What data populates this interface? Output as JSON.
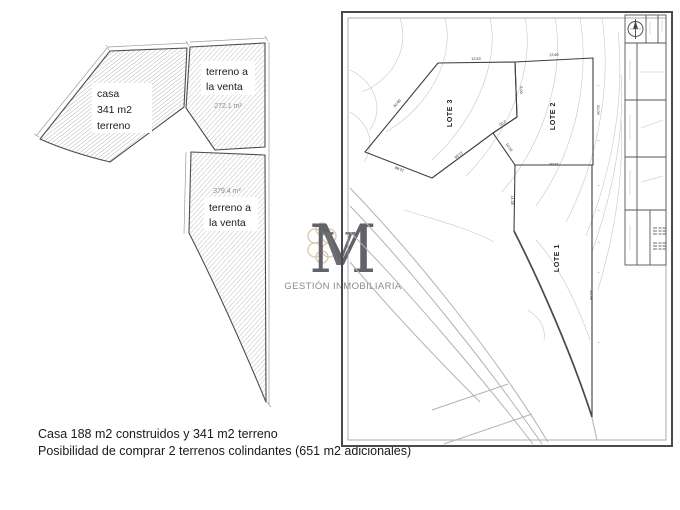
{
  "left_diagram": {
    "house_label": {
      "line1": "casa",
      "line2": "341 m2",
      "line3": "terreno"
    },
    "plot_upper": {
      "label_line1": "terreno a",
      "label_line2": "la venta",
      "area": "272.1 m²"
    },
    "plot_lower": {
      "area": "379.4 m²",
      "label_line1": "terreno a",
      "label_line2": "la venta"
    }
  },
  "logo": {
    "monogram_main": "M",
    "monogram_overlay": "V",
    "caption": "GESTIÓN INMOBILIARIA",
    "flourish_color": "#d9bfa0",
    "monogram_color": "#62626a"
  },
  "site_plan": {
    "lot_labels": [
      {
        "text": "LOTE 3",
        "x": 112,
        "y": 103
      },
      {
        "text": "LOTE 2",
        "x": 215,
        "y": 106
      },
      {
        "text": "LOTE 1",
        "x": 219,
        "y": 248
      }
    ],
    "dimensions": [
      {
        "text": "13.53",
        "x": 136,
        "y": 50,
        "r": -2
      },
      {
        "text": "13.60",
        "x": 214,
        "y": 46,
        "r": -3
      },
      {
        "text": "5.00",
        "x": 180,
        "y": 80,
        "r": 90
      },
      {
        "text": "20.00",
        "x": 58,
        "y": 94,
        "r": -51
      },
      {
        "text": "12.88",
        "x": 60,
        "y": 158,
        "r": 201
      },
      {
        "text": "12.66",
        "x": 118,
        "y": 144,
        "r": 143
      },
      {
        "text": "10.00",
        "x": 168,
        "y": 138,
        "r": 56
      },
      {
        "text": "2.00",
        "x": 162,
        "y": 112,
        "r": 147
      },
      {
        "text": "10.00",
        "x": 257,
        "y": 100,
        "r": 90
      },
      {
        "text": "13.60",
        "x": 214,
        "y": 153,
        "r": 180
      },
      {
        "text": "14.38",
        "x": 171,
        "y": 190,
        "r": 89
      },
      {
        "text": "43.98",
        "x": 250,
        "y": 285,
        "r": 90
      }
    ]
  },
  "caption": {
    "line1": "Casa 188 m2 construidos y 341 m2 terreno",
    "line2": "Posibilidad de comprar 2 terrenos colindantes (651 m2 adicionales)"
  }
}
